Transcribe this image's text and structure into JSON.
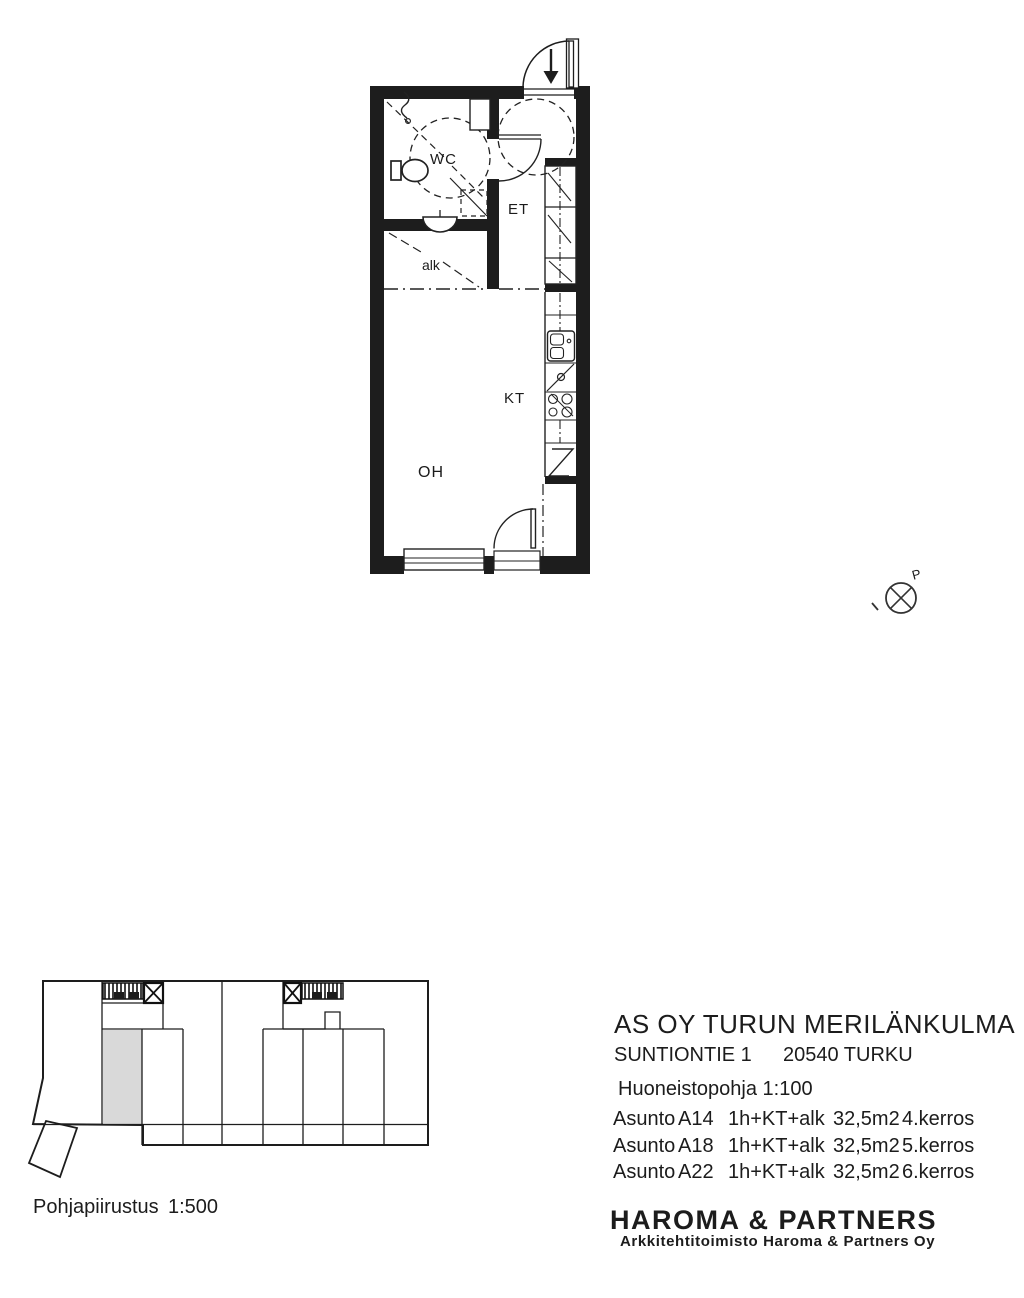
{
  "project": {
    "title": "AS OY TURUN MERILÄNKULMA",
    "street": "SUNTIONTIE 1",
    "city": "20540 TURKU",
    "plan_scale": "Huoneistopohja 1:100",
    "apartments": [
      {
        "label": "Asunto",
        "id": "A14",
        "type": "1h+KT+alk",
        "area": "32,5m2",
        "floor": "4.kerros"
      },
      {
        "label": "Asunto",
        "id": "A18",
        "type": "1h+KT+alk",
        "area": "32,5m2",
        "floor": "5.kerros"
      },
      {
        "label": "Asunto",
        "id": "A22",
        "type": "1h+KT+alk",
        "area": "32,5m2",
        "floor": "6.kerros"
      }
    ],
    "firm_name": "HAROMA & PARTNERS",
    "firm_subtitle": "Arkkitehtitoimisto Haroma & Partners Oy"
  },
  "floor_plan": {
    "labels": {
      "wc": "WC",
      "et": "ET",
      "alk": "alk",
      "kt": "KT",
      "oh": "OH"
    }
  },
  "site_plan": {
    "label": "Pohjapiirustus",
    "scale": "1:500"
  },
  "north_indicator": {
    "letter": "P"
  },
  "colors": {
    "line": "#1d1d1d",
    "highlighted_unit": "#d9d9d9",
    "paper": "#ffffff"
  }
}
